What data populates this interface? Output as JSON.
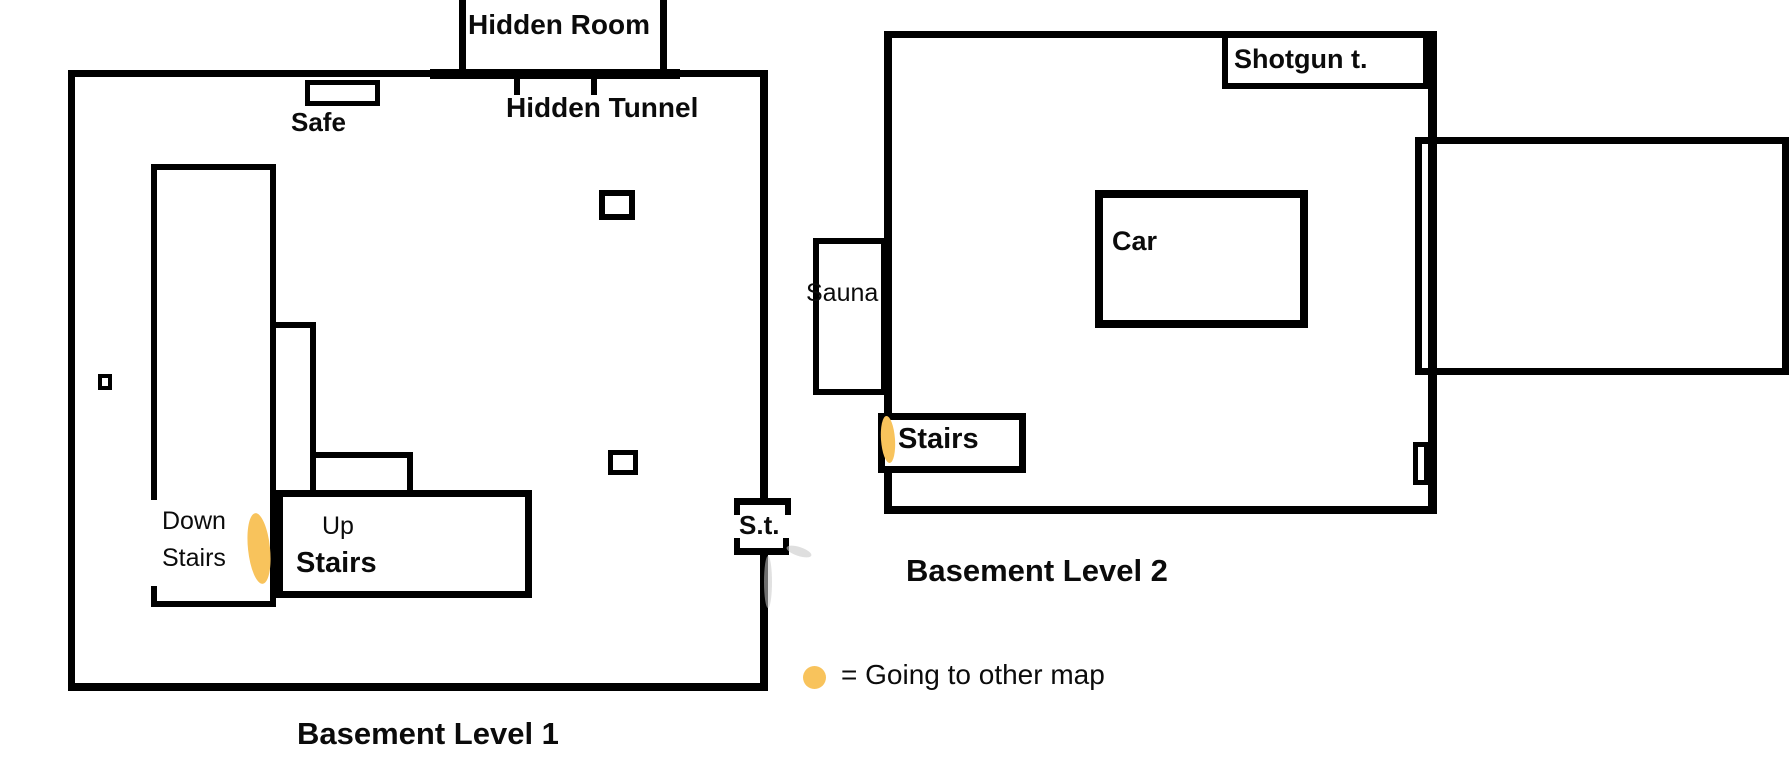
{
  "colors": {
    "wall": "#000000",
    "marker": "#F8C35C",
    "background": "#FFFFFF",
    "smudge": "#C9C9C9"
  },
  "level1": {
    "title": "Basement Level 1",
    "hidden_room_label": "Hidden Room",
    "hidden_tunnel_label": "Hidden Tunnel",
    "safe_label": "Safe",
    "down_stairs_line1": "Down",
    "down_stairs_line2": "Stairs",
    "up_stairs_line1": "Up",
    "up_stairs_line2": "Stairs",
    "secret_tunnel_label": "S.t."
  },
  "level2": {
    "title": "Basement Level 2",
    "shotgun_table_label": "Shotgun t.",
    "car_label": "Car",
    "sauna_label": "Sauna",
    "stairs_label": "Stairs"
  },
  "legend": {
    "marker_icon": "orange-dot",
    "text": "= Going to other map"
  }
}
